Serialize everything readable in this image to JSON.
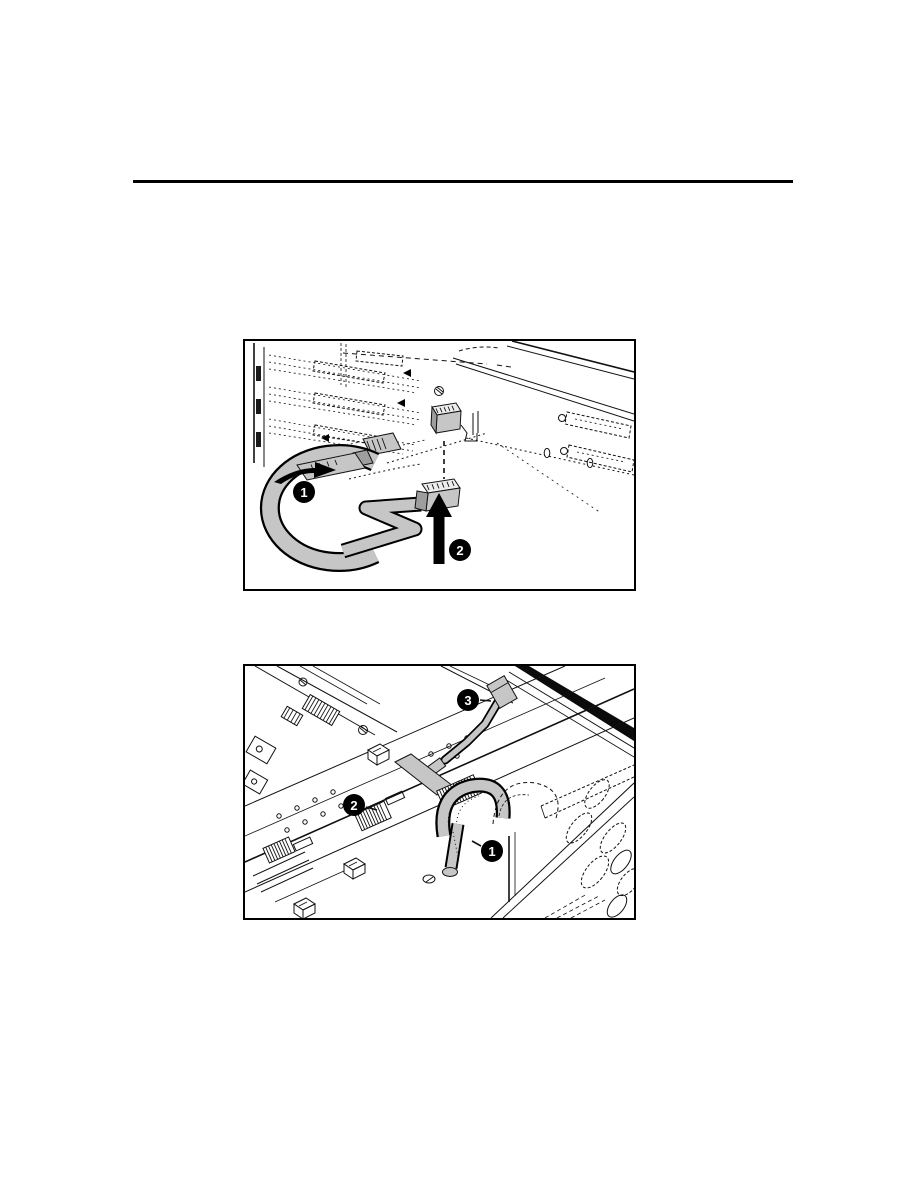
{
  "page": {
    "background_color": "#ffffff",
    "divider_color": "#000000",
    "figure_border_color": "#000000"
  },
  "figure1": {
    "cable_color": "#c6c6c6",
    "callouts": [
      {
        "label": "1"
      },
      {
        "label": "2"
      }
    ]
  },
  "figure2": {
    "cable_color": "#c6c6c6",
    "callouts": [
      {
        "label": "1"
      },
      {
        "label": "2"
      },
      {
        "label": "3"
      }
    ]
  }
}
